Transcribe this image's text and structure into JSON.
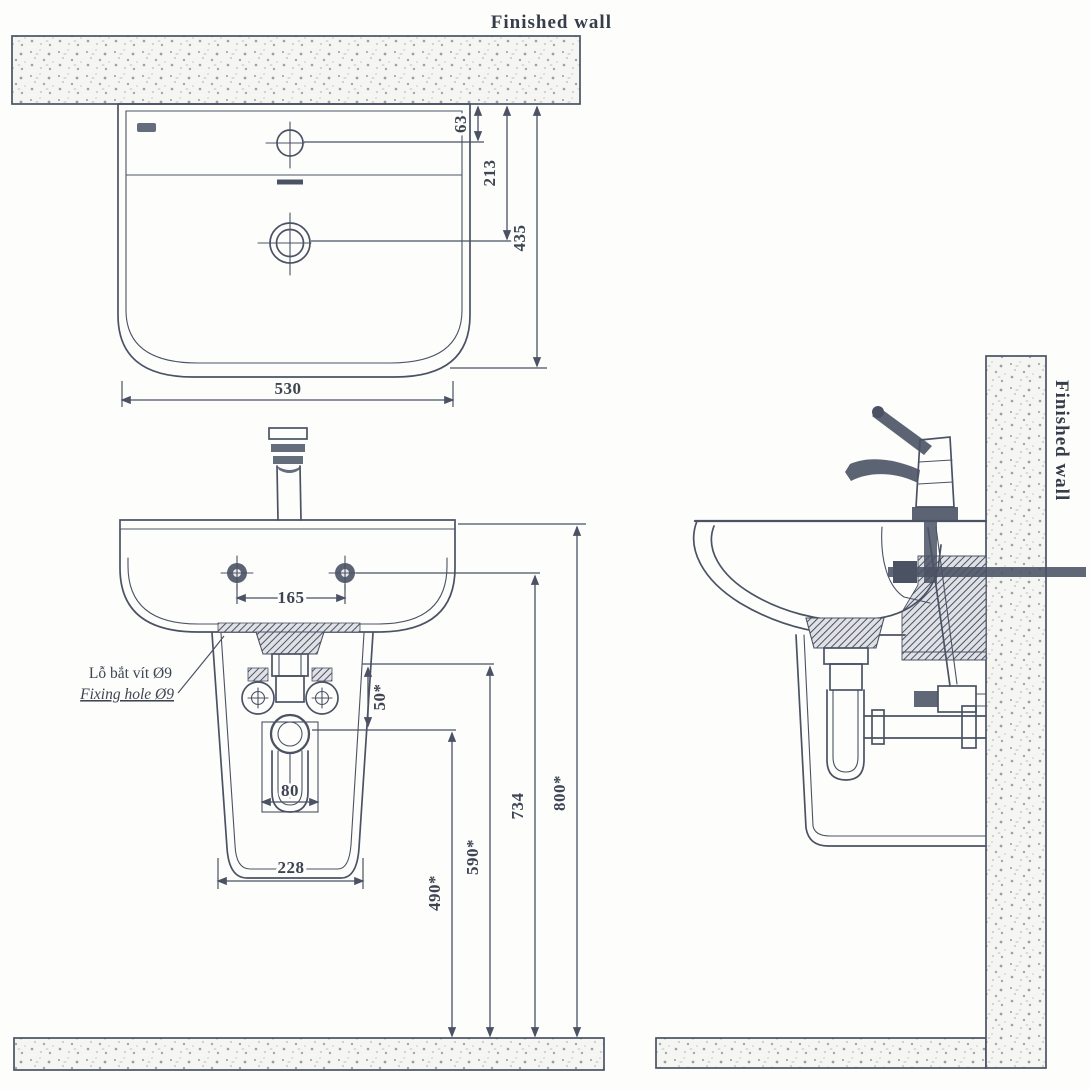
{
  "labels": {
    "finished_wall_top": "Finished wall",
    "finished_wall_side": "Finished wall",
    "fixing_hole_vi": "Lỗ bắt vít Ø9",
    "fixing_hole_en": "Fixing hole Ø9"
  },
  "dimensions": {
    "top_view": {
      "faucet_hole_to_wall": "63",
      "drain_to_wall": "213",
      "basin_depth": "435",
      "basin_width": "530"
    },
    "front_view": {
      "fixing_hole_spacing": "165",
      "trap_detail_width": "80",
      "pedestal_width": "228",
      "valve_offset": "50*",
      "drain_outlet_height": "490*",
      "supply_height": "590*",
      "fixing_bolt_height": "734",
      "rim_height": "800*"
    }
  },
  "colors": {
    "line": "#4a5264",
    "paper": "#fdfdfb"
  }
}
